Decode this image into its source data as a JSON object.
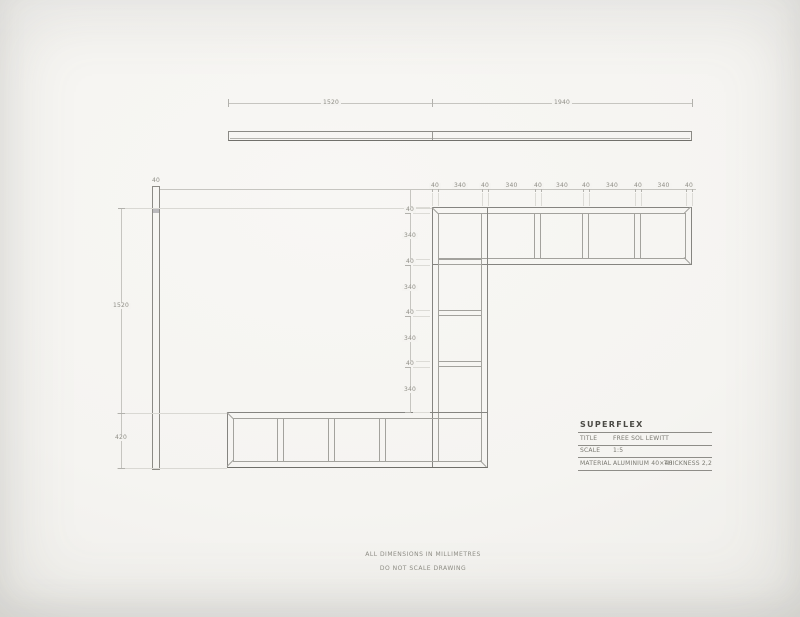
{
  "sheet": {
    "artist": "SUPERFLEX",
    "title_block": {
      "rows": [
        {
          "label": "TITLE",
          "value": "FREE SOL LEWITT",
          "extra": ""
        },
        {
          "label": "SCALE",
          "value": "1:5",
          "extra": ""
        },
        {
          "label": "MATERIAL",
          "value": "ALUMINIUM 40×40",
          "extra": "THICKNESS 2,2"
        }
      ]
    },
    "notes": [
      "ALL DIMENSIONS IN MILLIMETRES",
      "DO NOT SCALE DRAWING"
    ],
    "dimensions": {
      "top_bar_segments": [
        "1520",
        "1940"
      ],
      "left_bar_width": "40",
      "left_bar_chain": [
        "1520",
        "420"
      ],
      "shelf_top_chain": [
        "40",
        "340",
        "40",
        "340",
        "40",
        "340",
        "40",
        "340",
        "40",
        "340",
        "40"
      ],
      "column_side_chain": [
        "40",
        "340",
        "40",
        "340",
        "40",
        "340",
        "40",
        "340"
      ]
    },
    "colors": {
      "paper": "#f5f4f1",
      "structure_line": "#858480",
      "inner_line": "#a3a29d",
      "dim_line": "#c6c5c0",
      "dim_text": "#8f8e86",
      "title_text": "#4b4a45"
    }
  }
}
